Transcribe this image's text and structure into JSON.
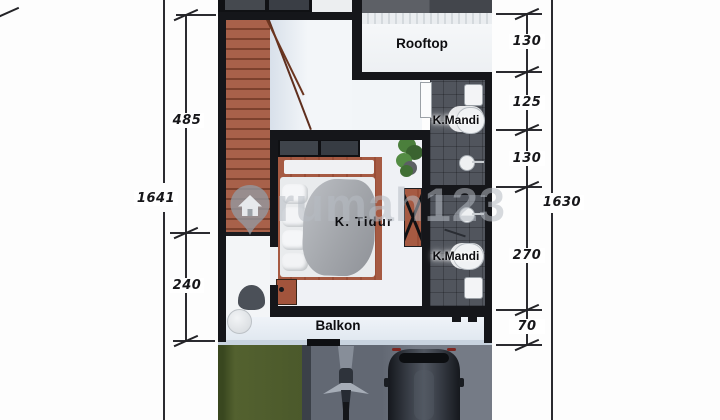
{
  "watermark": {
    "text": "rumah123"
  },
  "icons": {
    "watermark_pin": "map-pin-house-icon"
  },
  "rooms": {
    "rooftop": "Rooftop",
    "bathroom_upper": "K.Mandi",
    "bedroom": "K. Tidur",
    "bathroom_lower": "K.Mandi",
    "balcony": "Balkon"
  },
  "dimensions": {
    "left": {
      "total": "1641",
      "seg_top": "485",
      "seg_bottom": "240"
    },
    "right": {
      "total": "1630",
      "seg1": "130",
      "seg2": "125",
      "seg3": "130",
      "seg4": "270",
      "seg5": "70"
    }
  },
  "colors": {
    "wall": "#15161a",
    "wood": "#a2583f",
    "tile": "#51555d",
    "floor_white": "#f1f4f7",
    "grass": "#4c5a2d",
    "driveway": "#6e747f",
    "dimension_ink": "#2b2b30",
    "watermark_gray": "#aab0b6"
  }
}
